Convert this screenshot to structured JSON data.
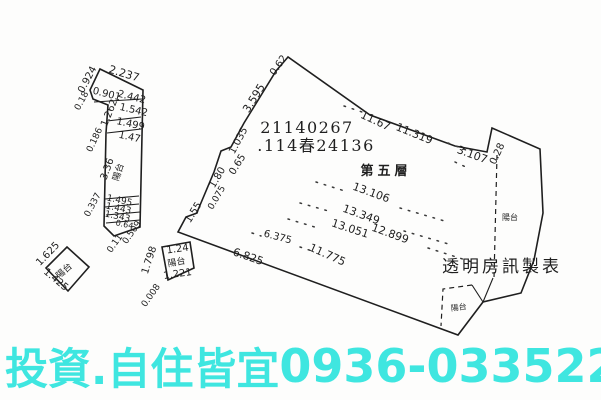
{
  "page": {
    "background": "#fdfdfc",
    "ink": "#1f1f1f"
  },
  "header": {
    "registry_number": "21140267",
    "case_number": ".114春24136",
    "floor_label": "第五層",
    "publisher": "透明房訊製表"
  },
  "banner": {
    "slogan": "投資.自住皆宜",
    "phone": "0936-033522",
    "color": "#3fe6e0"
  },
  "plan": {
    "balcony_label": "陽台",
    "labels": [
      {
        "t": "21140267",
        "x": 307,
        "y": 133,
        "s": 16,
        "c": "serif sp1",
        "n": "registry-number"
      },
      {
        "t": ".114春24136",
        "x": 316,
        "y": 151,
        "s": 16,
        "c": "serif sp1",
        "n": "case-number"
      },
      {
        "t": "第五層",
        "x": 386,
        "y": 175,
        "s": 13,
        "c": "serif cjk-bold",
        "n": "floor-label"
      },
      {
        "t": "透明房訊製表",
        "x": 502,
        "y": 272,
        "s": 17,
        "c": "serif sp2",
        "n": "publisher-watermark"
      },
      {
        "t": "0.62",
        "x": 281,
        "y": 67,
        "r": -55,
        "s": 10
      },
      {
        "t": "11.67",
        "x": 374,
        "y": 124,
        "r": 25,
        "s": 11
      },
      {
        "t": "11.319",
        "x": 413,
        "y": 137,
        "r": 22,
        "s": 11
      },
      {
        "t": "3.107",
        "x": 471,
        "y": 158,
        "r": 20,
        "s": 11
      },
      {
        "t": "0.28",
        "x": 500,
        "y": 155,
        "r": -65,
        "s": 10
      },
      {
        "t": "3.595",
        "x": 257,
        "y": 100,
        "r": -58,
        "s": 11
      },
      {
        "t": "1.035",
        "x": 241,
        "y": 142,
        "r": -62,
        "s": 10
      },
      {
        "t": "0.65",
        "x": 240,
        "y": 166,
        "r": -58,
        "s": 10
      },
      {
        "t": "1.80",
        "x": 220,
        "y": 179,
        "r": -60,
        "s": 10
      },
      {
        "t": "0.075",
        "x": 219,
        "y": 199,
        "r": -60,
        "s": 9
      },
      {
        "t": "1.55",
        "x": 196,
        "y": 214,
        "r": -58,
        "s": 10
      },
      {
        "t": "6.825",
        "x": 247,
        "y": 260,
        "r": 19,
        "s": 11
      },
      {
        "t": "6.375",
        "x": 277,
        "y": 240,
        "r": 15,
        "s": 10
      },
      {
        "t": "11.775",
        "x": 326,
        "y": 258,
        "r": 24,
        "s": 11
      },
      {
        "t": "13.106",
        "x": 370,
        "y": 196,
        "r": 20,
        "s": 11
      },
      {
        "t": "13.349",
        "x": 360,
        "y": 218,
        "r": 20,
        "s": 11
      },
      {
        "t": "13.051",
        "x": 349,
        "y": 232,
        "r": 18,
        "s": 11
      },
      {
        "t": "12.899",
        "x": 389,
        "y": 237,
        "r": 20,
        "s": 11
      },
      {
        "t": "陽台",
        "x": 510,
        "y": 220,
        "s": 8,
        "n": "balcony-label"
      },
      {
        "t": "陽台",
        "x": 459,
        "y": 310,
        "r": -8,
        "s": 8,
        "n": "balcony-label"
      },
      {
        "t": "陽台",
        "x": 121,
        "y": 173,
        "r": -72,
        "s": 9,
        "n": "balcony-label"
      },
      {
        "t": "陽台",
        "x": 66,
        "y": 273,
        "r": -42,
        "s": 9,
        "n": "balcony-label"
      },
      {
        "t": "陽台",
        "x": 177,
        "y": 265,
        "r": -10,
        "s": 9,
        "n": "balcony-label"
      },
      {
        "t": "0.924",
        "x": 90,
        "y": 81,
        "r": -62,
        "s": 10
      },
      {
        "t": "2.237",
        "x": 123,
        "y": 77,
        "r": 17,
        "s": 11
      },
      {
        "t": "0.18",
        "x": 84,
        "y": 102,
        "r": -62,
        "s": 9
      },
      {
        "t": "0.901",
        "x": 106,
        "y": 97,
        "r": 14,
        "s": 10
      },
      {
        "t": "2.442",
        "x": 131,
        "y": 100,
        "r": 14,
        "s": 10
      },
      {
        "t": "1.262",
        "x": 112,
        "y": 114,
        "r": -68,
        "s": 10
      },
      {
        "t": "1.542",
        "x": 133,
        "y": 113,
        "r": 13,
        "s": 10
      },
      {
        "t": "1.499",
        "x": 130,
        "y": 127,
        "r": 12,
        "s": 10
      },
      {
        "t": "1.47",
        "x": 129,
        "y": 140,
        "r": 12,
        "s": 10
      },
      {
        "t": "0.186",
        "x": 97,
        "y": 141,
        "r": -65,
        "s": 9
      },
      {
        "t": "3.36",
        "x": 110,
        "y": 170,
        "r": -70,
        "s": 10
      },
      {
        "t": "0.337",
        "x": 95,
        "y": 206,
        "r": -62,
        "s": 9
      },
      {
        "t": "1.495",
        "x": 119,
        "y": 203,
        "r": 12,
        "s": 9
      },
      {
        "t": "1.443",
        "x": 118,
        "y": 211,
        "r": 12,
        "s": 9
      },
      {
        "t": "1.343",
        "x": 117,
        "y": 219,
        "r": 12,
        "s": 9
      },
      {
        "t": "0.64",
        "x": 124,
        "y": 227,
        "r": 12,
        "s": 8
      },
      {
        "t": "0.509",
        "x": 134,
        "y": 234,
        "r": -55,
        "s": 9
      },
      {
        "t": "0.11",
        "x": 117,
        "y": 245,
        "r": -55,
        "s": 9
      },
      {
        "t": "1.625",
        "x": 50,
        "y": 256,
        "r": -46,
        "s": 10
      },
      {
        "t": "1.425",
        "x": 54,
        "y": 282,
        "r": 40,
        "s": 10
      },
      {
        "t": "1.798",
        "x": 152,
        "y": 261,
        "r": -72,
        "s": 10
      },
      {
        "t": "1.24",
        "x": 178,
        "y": 252,
        "r": -8,
        "s": 10
      },
      {
        "t": "1.221",
        "x": 178,
        "y": 277,
        "r": -8,
        "s": 10
      },
      {
        "t": "0.008",
        "x": 153,
        "y": 297,
        "r": -55,
        "s": 9
      }
    ]
  }
}
